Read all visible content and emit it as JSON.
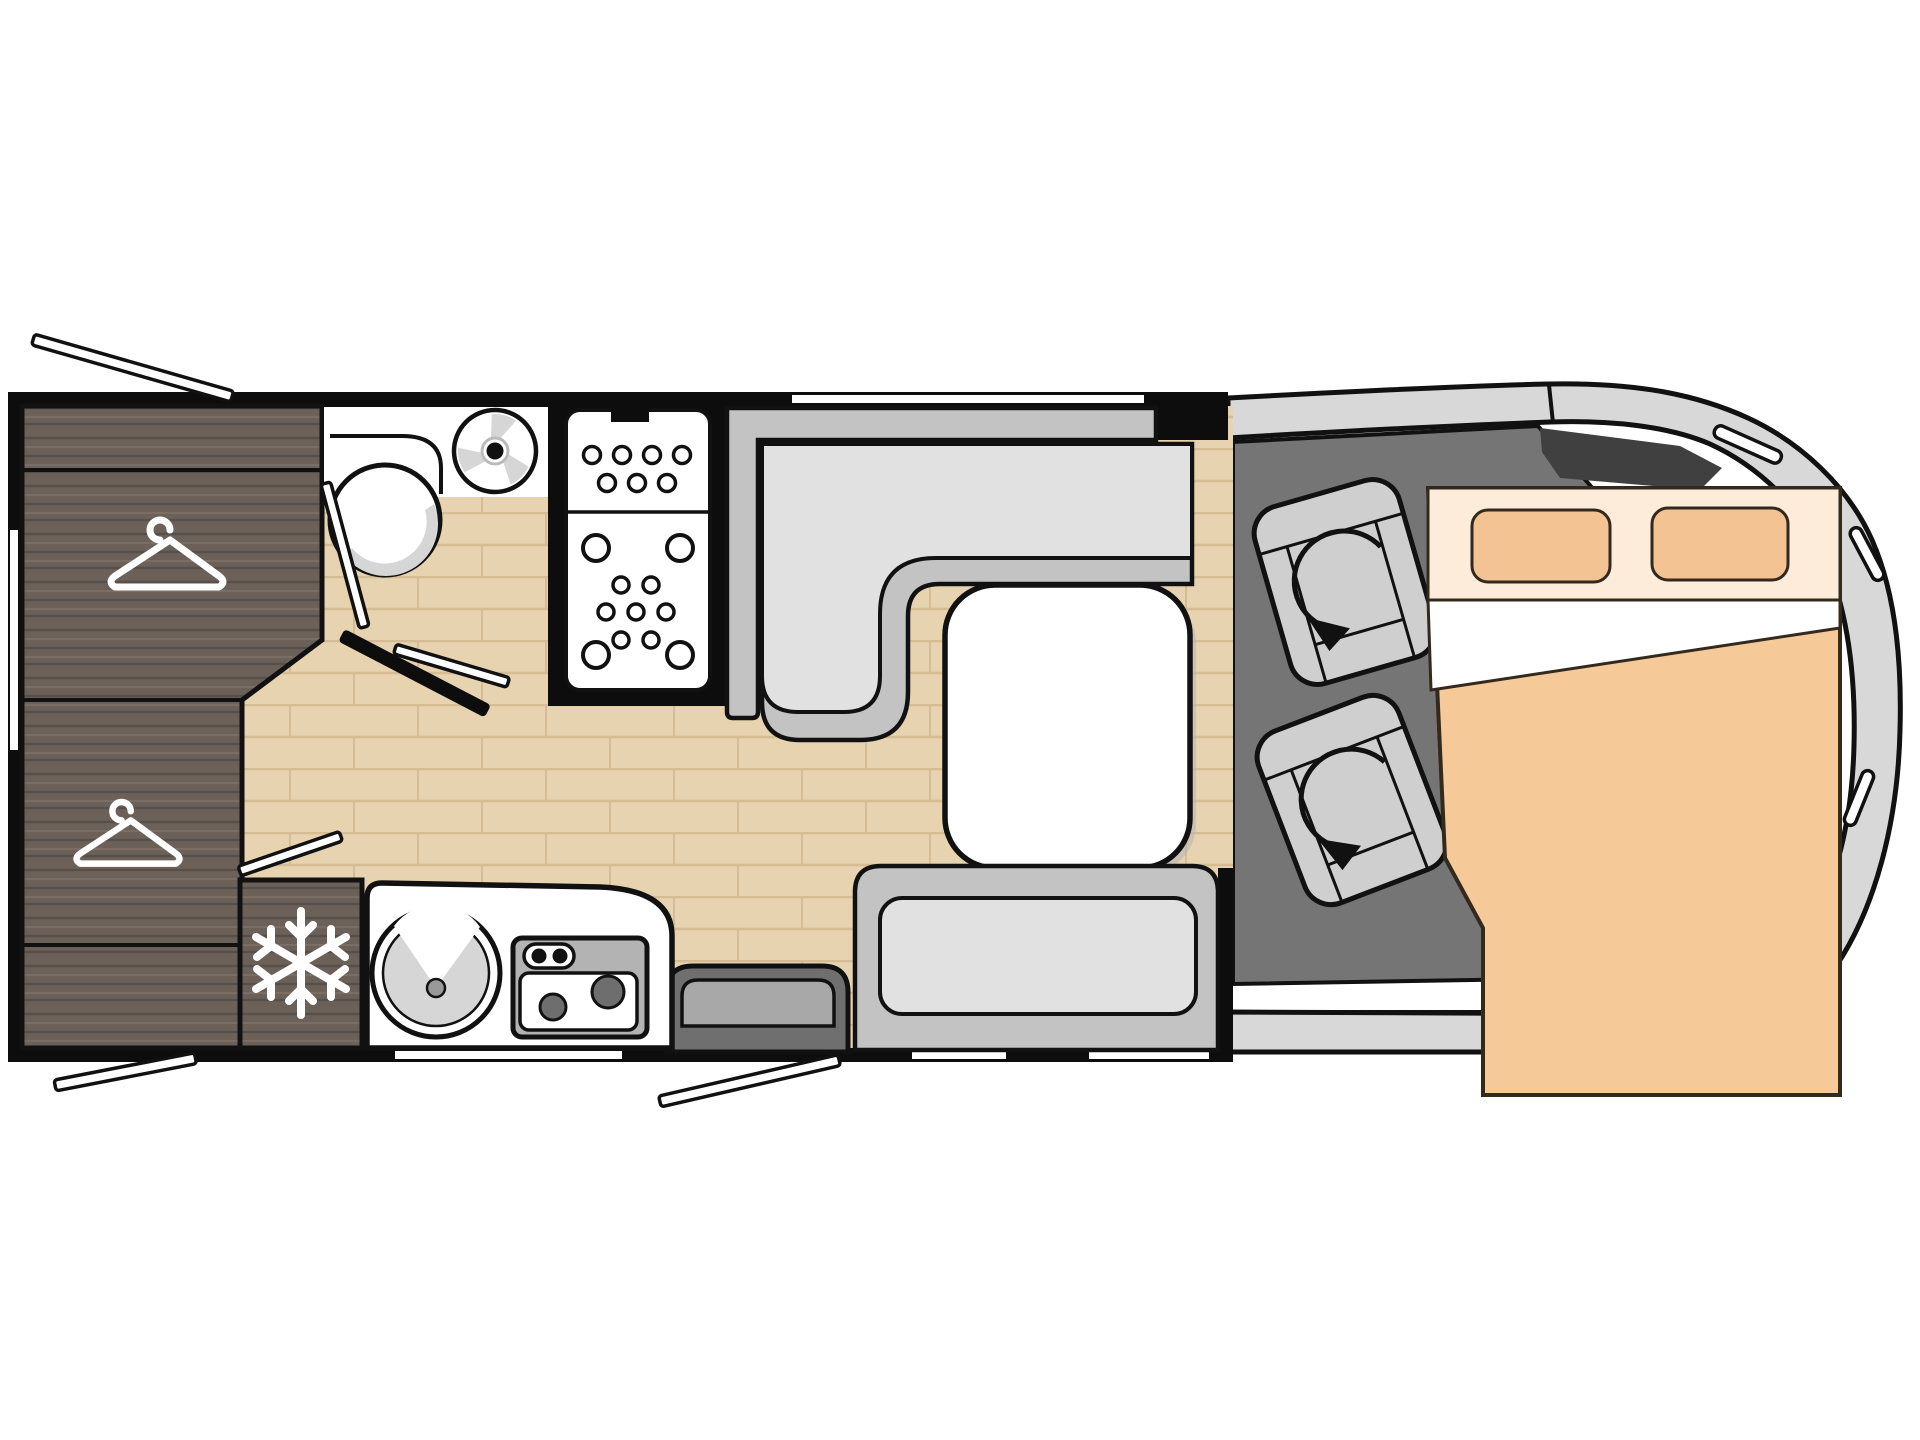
{
  "diagram": {
    "type": "motorhome-floor-plan",
    "view": "top-down",
    "vehicle_zones": [
      "rear-wardrobe",
      "bathroom",
      "shower",
      "kitchen",
      "dinette",
      "entrance",
      "cab",
      "drop-down-bed"
    ]
  },
  "palette": {
    "bg": "#ffffff",
    "wall": "#0d0d0d",
    "floor_base": "#e7d3b0",
    "floor_line": "#d5bc94",
    "wood_base": "#6b6159",
    "wood_dark": "#57504a",
    "wood_light": "#7d736a",
    "white": "#ffffff",
    "bench_mid": "#c3c3c3",
    "bench_light": "#e1e1e1",
    "outline": "#111111",
    "step_dark": "#6f6f6f",
    "step_light": "#a8a8a8",
    "cab_floor": "#757575",
    "dash_dark": "#404040",
    "body_gray": "#d8d8d8",
    "seat_gray": "#cfcfcf",
    "seat_band": "#bcbcbc",
    "bed_mattress": "#f6c998",
    "bed_header": "#fcecd9",
    "bed_pillow": "#f3c394",
    "bed_outline": "#33291d",
    "stove_gray": "#b3b3b3",
    "burner": "#6e6e6e",
    "shade": "#d6d6d6",
    "shadow": "#b5b5b5"
  },
  "fixtures": {
    "plan": "Motorhome floor plan, top view",
    "wardrobe": "Rear wardrobe with two clothes hangers",
    "hanger": "Clothes hanger symbol",
    "freezer": "Freezer cabinet with snowflake symbol",
    "bathroom": "Bathroom with toilet and vanity",
    "toilet": "Toilet (top view)",
    "vanity": "Bathroom vanity counter",
    "roof_vent": "Roof vent fan",
    "shower": "Shower cabin with drain pattern",
    "kitchen": "Kitchen counter",
    "sink": "Round kitchen sink",
    "hob": "Two-burner hob with control knobs",
    "dinette_backrest": "Dinette backrest panels",
    "dinette_sofa": "L-shaped dinette sofa",
    "table": "Dinette table",
    "travel_bench": "Forward-facing travel bench",
    "entry_step": "Entrance step cabinet",
    "cab": "Driver cab floor",
    "driver_seat": "Swivelling driver seat",
    "passenger_seat": "Swivelling passenger seat",
    "swivel_arrow": "Seat swivel direction arrow",
    "cab_body": "Vehicle cab body outline",
    "bed": "Drop-down double bed",
    "pillow": "Pillow",
    "door_flap": "Open door / hatch swing indicator",
    "window": "Window opening in wall"
  },
  "counts": {
    "hangers": 2,
    "burners": 2,
    "swivel_seats": 2,
    "pillows": 2,
    "door_flaps": 4,
    "windows": 4
  }
}
